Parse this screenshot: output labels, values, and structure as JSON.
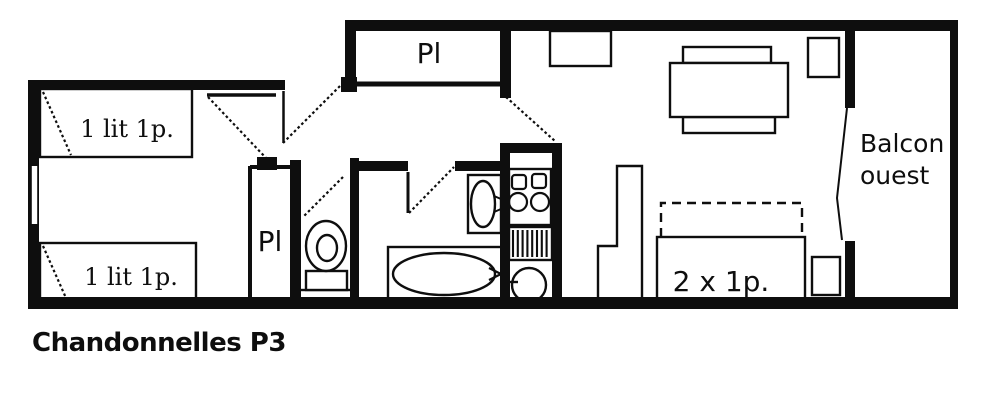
{
  "title": "Chandonnelles P3",
  "colors": {
    "ink": "#0e0e0e",
    "paper": "#ffffff"
  },
  "plan": {
    "bedroom": {
      "bed_top_label": "1 lit 1p.",
      "bed_bottom_label": "1 lit 1p.",
      "closet_label": "Pl"
    },
    "hall": {
      "closet_label": "Pl"
    },
    "living": {
      "sofa_bed_label": "2 x 1p."
    },
    "balcony": {
      "label_line1": "Balcon",
      "label_line2": "ouest"
    }
  }
}
